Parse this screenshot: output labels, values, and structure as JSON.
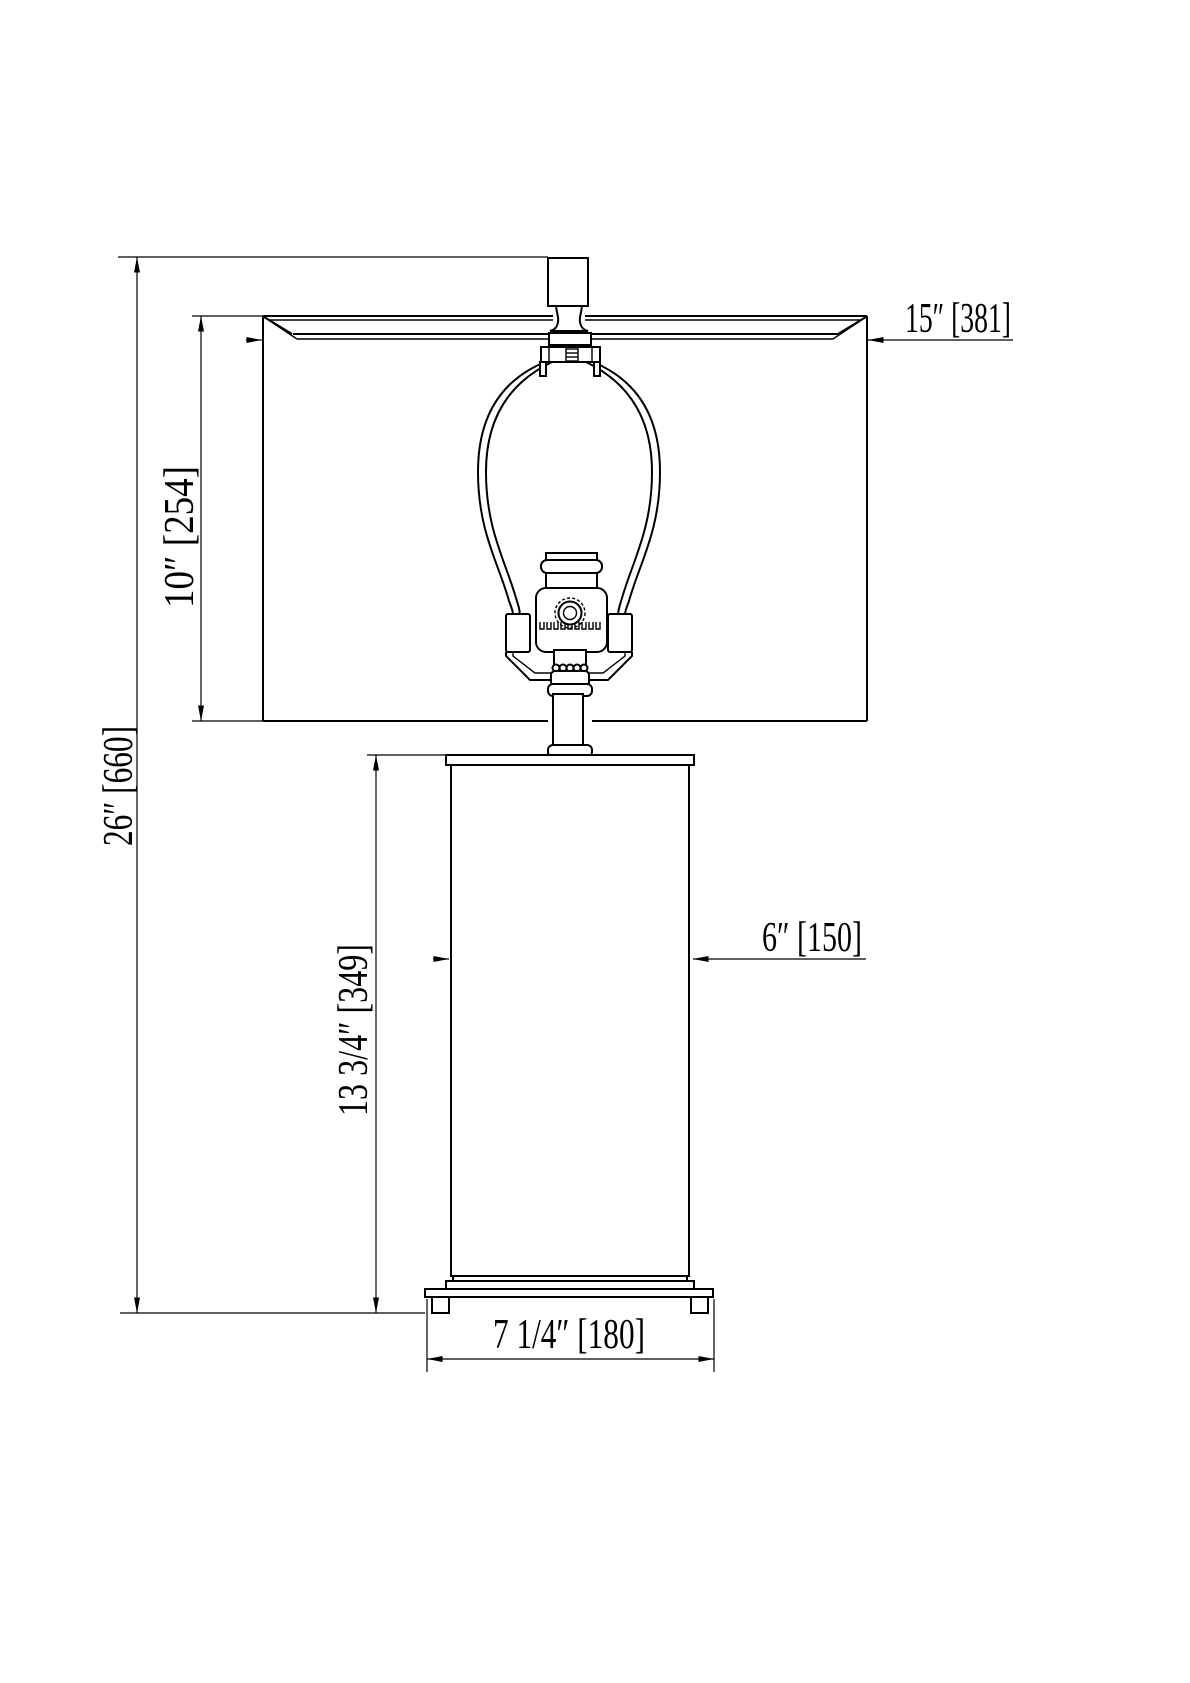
{
  "drawing": {
    "type": "technical dimension drawing",
    "subject": "table lamp elevation",
    "background_color": "#ffffff",
    "line_color": "#000000"
  },
  "dimensions": {
    "overall_height": {
      "label": "26″ [660]",
      "inches": "26″",
      "mm": 660
    },
    "shade_height": {
      "label": "10″ [254]",
      "inches": "10″",
      "mm": 254
    },
    "shade_width": {
      "label": "15″ [381]",
      "inches": "15″",
      "mm": 381
    },
    "body_width": {
      "label": "6″ [150]",
      "inches": "6″",
      "mm": 150
    },
    "body_height": {
      "label": "13 3/4″ [349]",
      "inches": "13 3/4″",
      "mm": 349
    },
    "base_width": {
      "label": "7 1/4″ [180]",
      "inches": "7 1/4″",
      "mm": 180
    }
  }
}
